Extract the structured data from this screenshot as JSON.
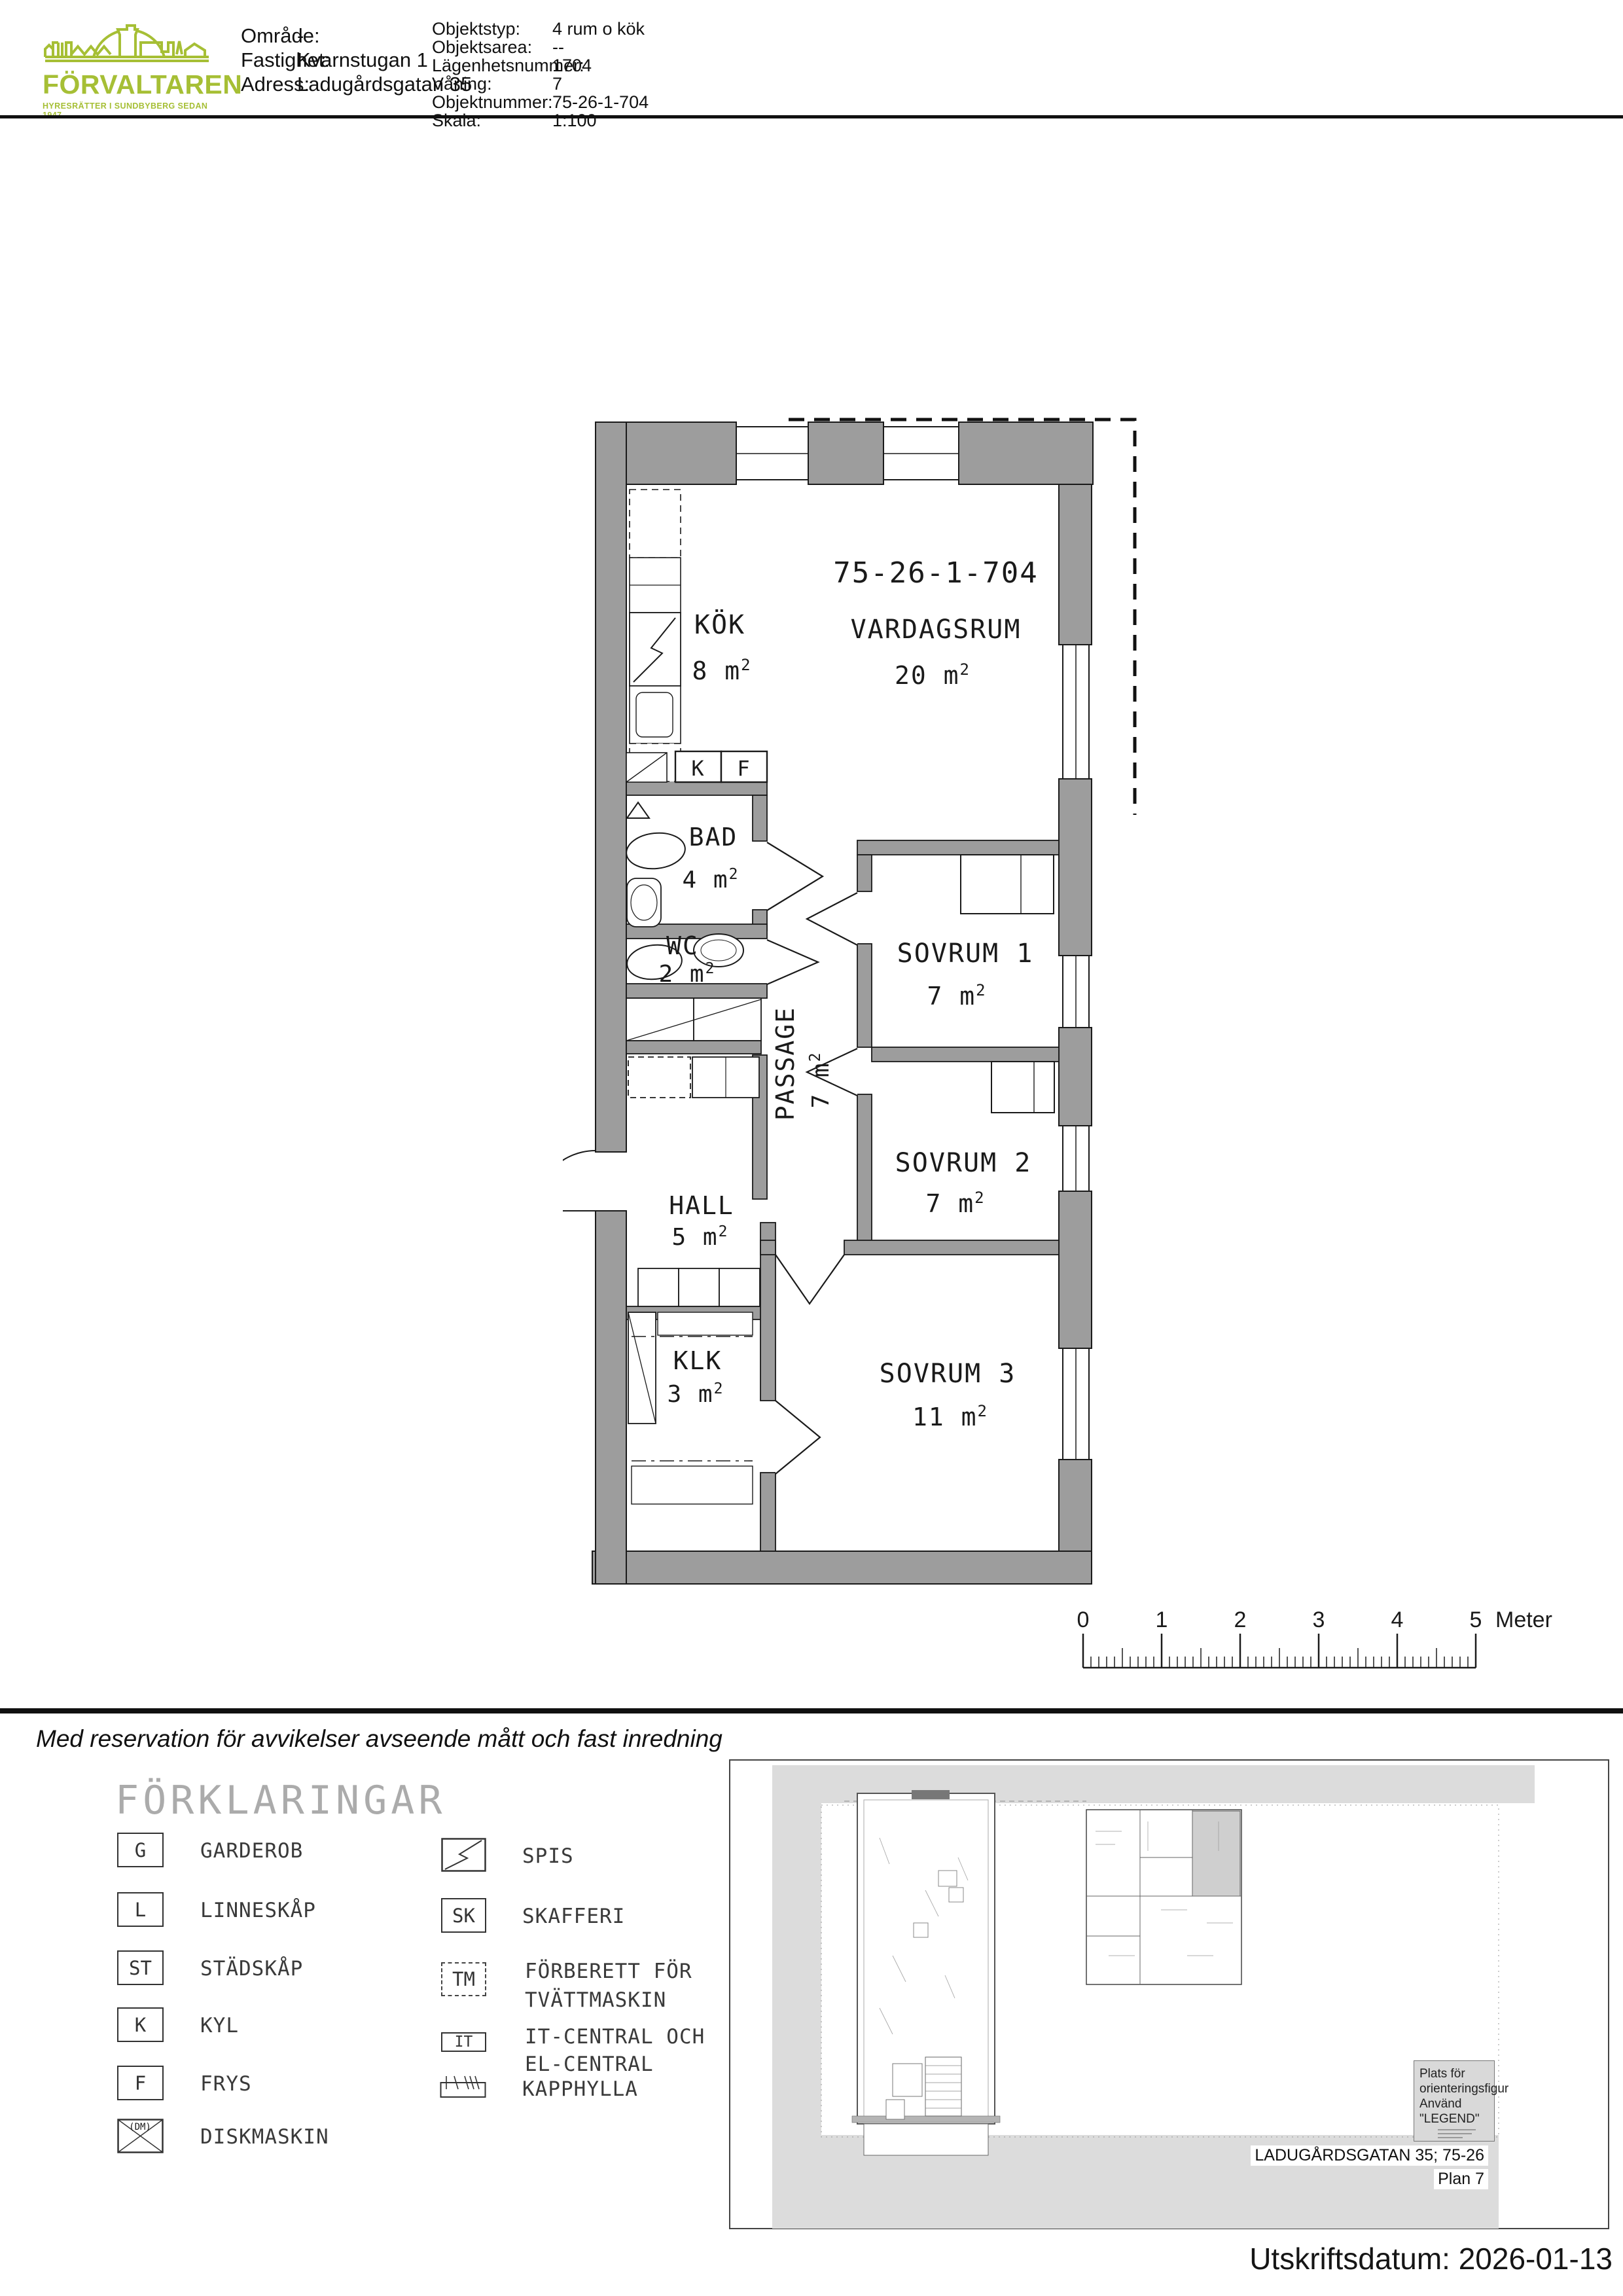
{
  "colors": {
    "brand_green": "#a6bf35",
    "wall_gray": "#9d9d9d",
    "panel_gray": "#dadada",
    "highlight_unit_gray": "#cfcfcf"
  },
  "header": {
    "logo": {
      "name": "FÖRVALTAREN",
      "tagline": "HYRESRÄTTER I SUNDBYBERG SEDAN 1947"
    },
    "property_info": {
      "rows": [
        {
          "label": "Område:",
          "value": "-"
        },
        {
          "label": "Fastighet:",
          "value": "Kvarnstugan 1"
        },
        {
          "label": "Adress:",
          "value": "Ladugårdsgatan 35"
        }
      ]
    },
    "object_info": {
      "rows": [
        {
          "label": "Objektstyp:",
          "value": "4 rum o kök"
        },
        {
          "label": "Objektsarea:",
          "value": "--"
        },
        {
          "label": "Lägenhetsnummer:",
          "value": "1704"
        },
        {
          "label": "Våning:",
          "value": "7"
        },
        {
          "label": "Objektnummer:",
          "value": "75-26-1-704"
        },
        {
          "label": "Skala:",
          "value": "1:100"
        }
      ]
    }
  },
  "floor_plan": {
    "apartment_number": "75-26-1-704",
    "superscript": "2",
    "rooms": [
      {
        "name": "KÖK",
        "area": "8 m"
      },
      {
        "name": "VARDAGSRUM",
        "area": "20 m"
      },
      {
        "name": "BAD",
        "area": "4 m"
      },
      {
        "name": "WC",
        "area": "2 m"
      },
      {
        "name": "PASSAGE",
        "area": "7 m"
      },
      {
        "name": "HALL",
        "area": "5 m"
      },
      {
        "name": "SOVRUM 1",
        "area": "7 m"
      },
      {
        "name": "SOVRUM 2",
        "area": "7 m"
      },
      {
        "name": "KLK",
        "area": "3 m"
      },
      {
        "name": "SOVRUM 3",
        "area": "11 m"
      }
    ],
    "fixtures": {
      "kyl": "K",
      "frys": "F"
    }
  },
  "scale_bar": {
    "labels": [
      "0",
      "1",
      "2",
      "3",
      "4",
      "5"
    ],
    "unit": "Meter"
  },
  "disclaimer": "Med reservation för avvikelser avseende mått och fast inredning",
  "legend": {
    "title": "FÖRKLARINGAR",
    "left_items": [
      {
        "symbol": "G",
        "label": "GARDEROB"
      },
      {
        "symbol": "L",
        "label": "LINNESKÅP"
      },
      {
        "symbol": "ST",
        "label": "STÄDSKÅP"
      },
      {
        "symbol": "K",
        "label": "KYL"
      },
      {
        "symbol": "F",
        "label": "FRYS"
      },
      {
        "symbol": "(DM)",
        "label": "DISKMASKIN"
      }
    ],
    "right_items": [
      {
        "symbol": "",
        "label1": "SPIS",
        "label2": ""
      },
      {
        "symbol": "SK",
        "label1": "SKAFFERI",
        "label2": ""
      },
      {
        "symbol": "TM",
        "label1": "FÖRBERETT FÖR",
        "label2": "TVÄTTMASKIN"
      },
      {
        "symbol": "IT",
        "label1": "IT-CENTRAL OCH",
        "label2": "EL-CENTRAL"
      },
      {
        "symbol": "",
        "label1": "KAPPHYLLA",
        "label2": ""
      }
    ]
  },
  "overview": {
    "note_line1": "Plats för",
    "note_line2": "orienteringsfigur",
    "note_line3": "Använd \"LEGEND\"",
    "address": "LADUGÅRDSGATAN 35; 75-26",
    "plan_label": "Plan 7"
  },
  "footer": {
    "print_date_line": "Utskriftsdatum: 2026-01-13"
  }
}
